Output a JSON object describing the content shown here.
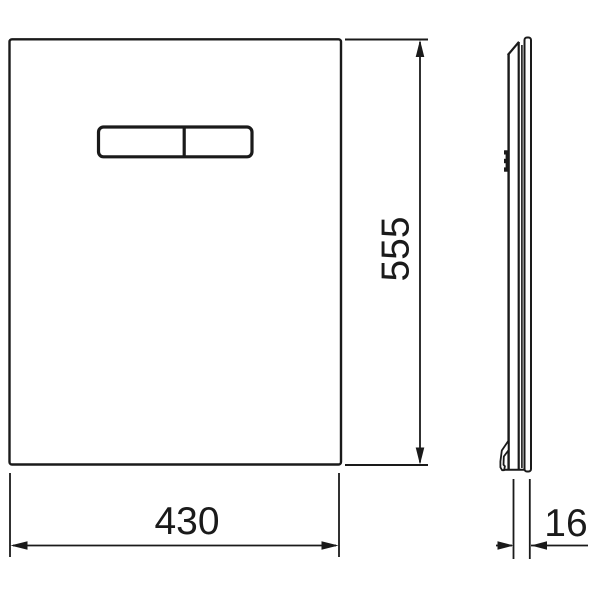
{
  "drawing": {
    "views": {
      "front_view": {
        "panel": "rectangular flush plate outline",
        "buttons": "dual flush button, split rocker"
      },
      "side_view": {
        "profile": "thin plate profile with top bevel, mounting clip and bottom hook"
      }
    },
    "dimensions": {
      "width": "430",
      "height": "555",
      "depth": "16"
    },
    "style": {
      "line_color": "#1a1a1a",
      "background": "#ffffff"
    }
  }
}
